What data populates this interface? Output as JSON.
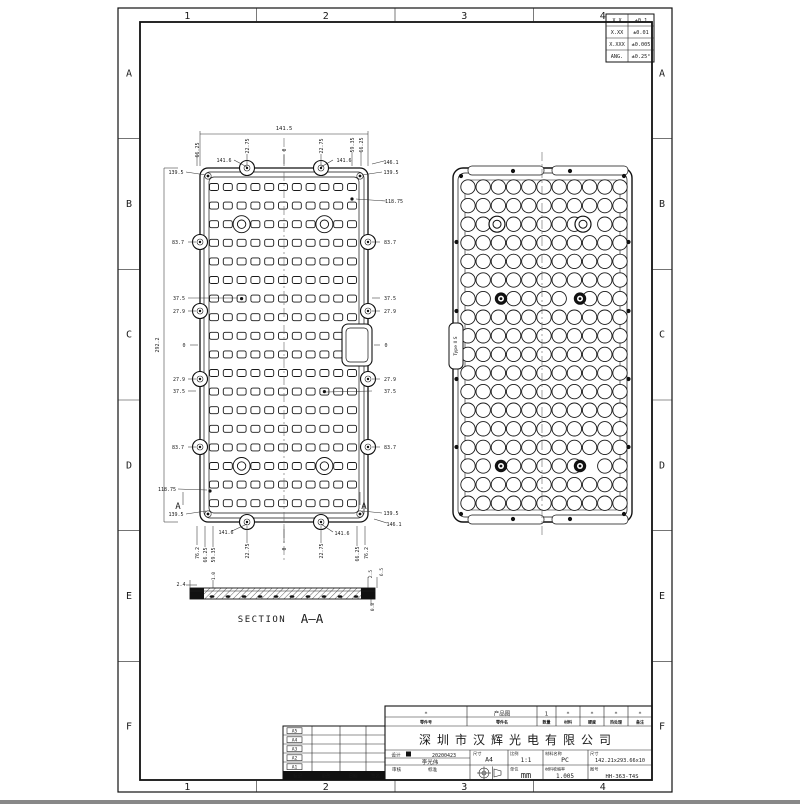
{
  "sheet": {
    "zone_numbers": [
      "1",
      "2",
      "3",
      "4"
    ],
    "zone_letters": [
      "A",
      "B",
      "C",
      "D",
      "E",
      "F"
    ]
  },
  "tolerance_table": {
    "rows": [
      [
        "X.X",
        "±0.1"
      ],
      [
        "X.XX",
        "±0.01"
      ],
      [
        "X.XXX",
        "±0.005"
      ],
      [
        "ANG.",
        "±0.25°"
      ]
    ]
  },
  "views": {
    "front": {
      "grid_cols": 11,
      "grid_rows": 18
    },
    "back": {
      "grid_cols": 11,
      "grid_rows": 18,
      "tab_label": "Type II S"
    },
    "section": {
      "label_prefix": "SECTION",
      "label": "A-A",
      "cut_letter": "A"
    }
  },
  "dims": [
    [
      "141.5",
      284,
      128,
      0,
      5.5
    ],
    [
      "66.25",
      197,
      150,
      -90,
      5
    ],
    [
      "141.6",
      224,
      160,
      0,
      5
    ],
    [
      "22.75",
      247,
      146,
      -90,
      5
    ],
    [
      "0",
      284,
      150,
      -90,
      5
    ],
    [
      "22.75",
      321,
      146,
      -90,
      5
    ],
    [
      "141.6",
      344,
      160,
      0,
      5
    ],
    [
      "59.35",
      352,
      145,
      -90,
      5
    ],
    [
      "66.25",
      361,
      145,
      -90,
      5
    ],
    [
      "146.1",
      391,
      162,
      0,
      5
    ],
    [
      "139.5",
      176,
      172,
      0,
      5
    ],
    [
      "139.5",
      391,
      172,
      0,
      5
    ],
    [
      "118.75",
      394,
      201,
      0,
      5
    ],
    [
      "83.7",
      178,
      242,
      0,
      5
    ],
    [
      "83.7",
      390,
      242,
      0,
      5
    ],
    [
      "37.5",
      179,
      298,
      0,
      5
    ],
    [
      "37.5",
      390,
      298,
      0,
      5
    ],
    [
      "27.9",
      179,
      311,
      0,
      5
    ],
    [
      "27.9",
      390,
      311,
      0,
      5
    ],
    [
      "292.2",
      157,
      345,
      -90,
      5
    ],
    [
      "0",
      184,
      345,
      0,
      5
    ],
    [
      "0",
      386,
      345,
      0,
      5
    ],
    [
      "27.9",
      179,
      379,
      0,
      5
    ],
    [
      "27.9",
      390,
      379,
      0,
      5
    ],
    [
      "37.5",
      179,
      391,
      0,
      5
    ],
    [
      "37.5",
      390,
      391,
      0,
      5
    ],
    [
      "83.7",
      178,
      447,
      0,
      5
    ],
    [
      "83.7",
      390,
      447,
      0,
      5
    ],
    [
      "118.75",
      167,
      489,
      0,
      5
    ],
    [
      "139.5",
      176,
      514,
      0,
      5
    ],
    [
      "139.5",
      391,
      513,
      0,
      5
    ],
    [
      "146.1",
      394,
      524,
      0,
      5
    ],
    [
      "141.6",
      226,
      532,
      0,
      5
    ],
    [
      "141.6",
      342,
      533,
      0,
      5
    ],
    [
      "76.2",
      197,
      553,
      -90,
      5
    ],
    [
      "66.25",
      205,
      555,
      -90,
      5
    ],
    [
      "59.35",
      213,
      555,
      -90,
      5
    ],
    [
      "22.75",
      247,
      551,
      -90,
      5
    ],
    [
      "0",
      284,
      549,
      -90,
      5
    ],
    [
      "22.75",
      321,
      551,
      -90,
      5
    ],
    [
      "66.25",
      357,
      554,
      -90,
      5
    ],
    [
      "76.2",
      366,
      553,
      -90,
      5
    ],
    [
      "2.4",
      181,
      584,
      0,
      5
    ],
    [
      "1.0",
      213,
      576,
      -90,
      4.5
    ],
    [
      "2.5",
      370,
      574,
      -90,
      4.5
    ],
    [
      "6.5",
      381,
      572,
      -90,
      4.5
    ],
    [
      "0.8",
      372,
      607,
      -90,
      4.5
    ]
  ],
  "cut_letters": [
    [
      178,
      509
    ],
    [
      364,
      509
    ]
  ],
  "lines": [
    [
      200,
      134,
      368,
      134
    ],
    [
      200,
      131,
      200,
      166
    ],
    [
      368,
      131,
      368,
      166
    ],
    [
      197,
      154,
      197,
      166
    ],
    [
      247,
      154,
      247,
      166
    ],
    [
      284,
      154,
      284,
      166
    ],
    [
      321,
      154,
      321,
      166
    ],
    [
      352,
      152,
      352,
      166
    ],
    [
      361,
      152,
      361,
      166
    ],
    [
      234,
      160,
      247,
      167
    ],
    [
      333,
      160,
      321,
      167
    ],
    [
      372,
      164,
      384,
      161
    ],
    [
      186,
      172,
      206,
      175
    ],
    [
      382,
      172,
      362,
      175
    ],
    [
      356,
      199,
      386,
      201
    ],
    [
      188,
      242,
      196,
      242
    ],
    [
      188,
      298,
      238,
      298
    ],
    [
      188,
      311,
      196,
      311
    ],
    [
      190,
      345,
      198,
      345
    ],
    [
      188,
      379,
      196,
      379
    ],
    [
      188,
      391,
      196,
      391
    ],
    [
      188,
      447,
      196,
      447
    ],
    [
      178,
      489,
      207,
      490
    ],
    [
      186,
      514,
      206,
      511
    ],
    [
      164,
      168,
      164,
      522
    ],
    [
      164,
      168,
      178,
      168
    ],
    [
      164,
      522,
      178,
      522
    ],
    [
      372,
      242,
      380,
      242
    ],
    [
      372,
      298,
      380,
      298
    ],
    [
      372,
      311,
      380,
      311
    ],
    [
      374,
      345,
      380,
      345
    ],
    [
      372,
      379,
      380,
      379
    ],
    [
      372,
      391,
      326,
      392
    ],
    [
      372,
      447,
      380,
      447
    ],
    [
      362,
      511,
      382,
      513
    ],
    [
      374,
      519,
      387,
      523
    ],
    [
      197,
      526,
      197,
      545
    ],
    [
      205,
      526,
      205,
      547
    ],
    [
      213,
      526,
      213,
      547
    ],
    [
      247,
      526,
      247,
      543
    ],
    [
      284,
      526,
      284,
      543
    ],
    [
      321,
      526,
      321,
      543
    ],
    [
      357,
      526,
      357,
      546
    ],
    [
      365,
      526,
      365,
      545
    ],
    [
      232,
      531,
      247,
      524
    ],
    [
      333,
      532,
      321,
      524
    ],
    [
      183,
      492,
      183,
      505
    ],
    [
      360,
      492,
      360,
      505
    ],
    [
      186,
      585,
      197,
      585
    ],
    [
      190,
      580,
      190,
      588
    ],
    [
      213,
      580,
      213,
      588
    ],
    [
      368,
      577,
      368,
      588
    ],
    [
      377,
      577,
      377,
      588
    ],
    [
      371,
      599,
      371,
      606
    ]
  ],
  "dots": [
    [
      352,
      199
    ],
    [
      241.6,
      298.6
    ],
    [
      324.4,
      391.6
    ],
    [
      210,
      491
    ]
  ],
  "title_block": {
    "parts_row": [
      "*",
      "产品图",
      "1",
      "*",
      "*",
      "*",
      "*"
    ],
    "parts_labels": [
      "零件号",
      "零件名",
      "数量",
      "材料",
      "硬度",
      "热处理",
      "备注"
    ],
    "company": "深圳市汉辉光电有限公司",
    "design_label": "设计",
    "design_date": "20200423",
    "designer": "李光伟",
    "check_label": "审核",
    "standard_label": "标准",
    "size_label": "尺寸",
    "size_value": "A4",
    "scale_label": "比例",
    "scale_value": "1:1",
    "material_label": "材料名称",
    "material_value": "PC",
    "dims_label": "尺寸",
    "dims_value": "142.21x293.66x10",
    "unit_label": "单位",
    "unit_value": "mm",
    "shrink_label": "材料收缩率",
    "shrink_value": "1.005",
    "no_label": "图号",
    "drawing_no": "HH-363-T4S"
  },
  "revision_table": {
    "rows": [
      "A5",
      "A4",
      "A3",
      "A2",
      "A1"
    ],
    "headers": [
      "标记",
      "更改",
      "日期",
      "签名"
    ]
  }
}
